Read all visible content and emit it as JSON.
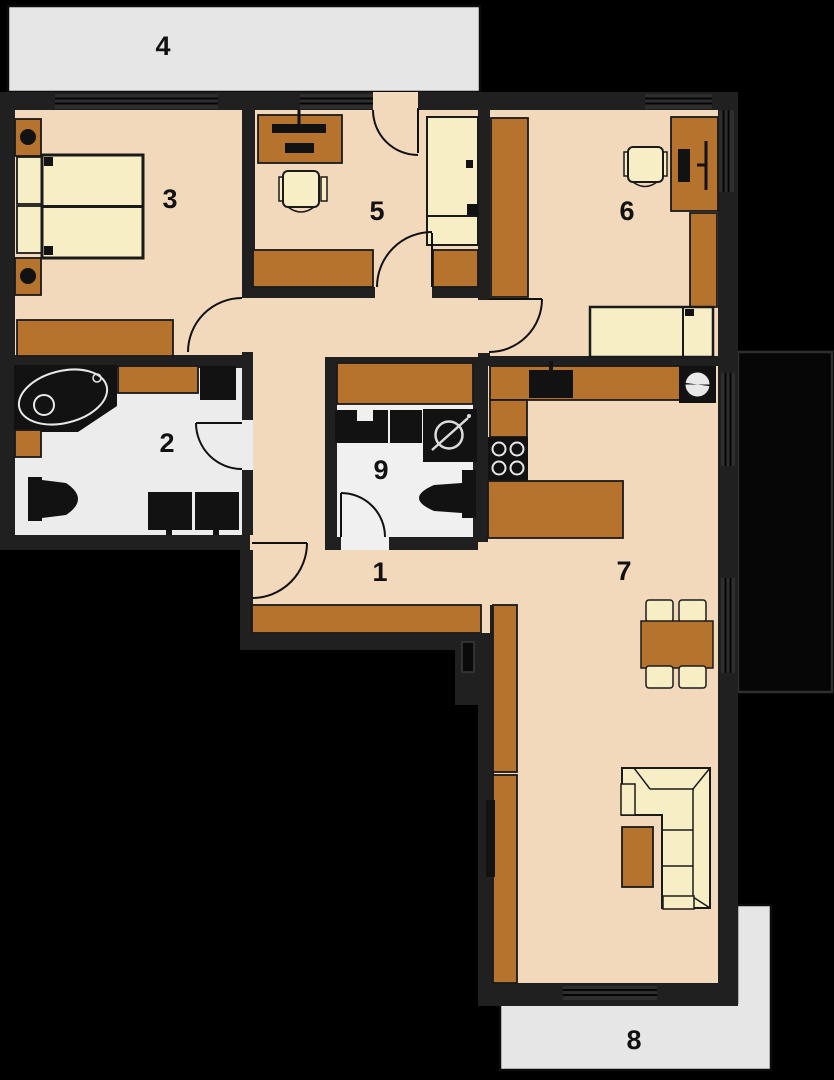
{
  "title": "Apartment floor plan",
  "room_labels": [
    {
      "label": "1"
    },
    {
      "label": "2"
    },
    {
      "label": "3"
    },
    {
      "label": "4"
    },
    {
      "label": "5"
    },
    {
      "label": "6"
    },
    {
      "label": "7"
    },
    {
      "label": "8"
    },
    {
      "label": "9"
    }
  ],
  "palette": {
    "background": "#000000",
    "wall": "#202020",
    "floor_main": "#f3d9bb",
    "floor_wet": "#ececec",
    "terrace": "#e6e6e6",
    "furniture_wood": "#b5732e",
    "furniture_soft": "#f8eec6",
    "fixture_dark": "#121212"
  }
}
